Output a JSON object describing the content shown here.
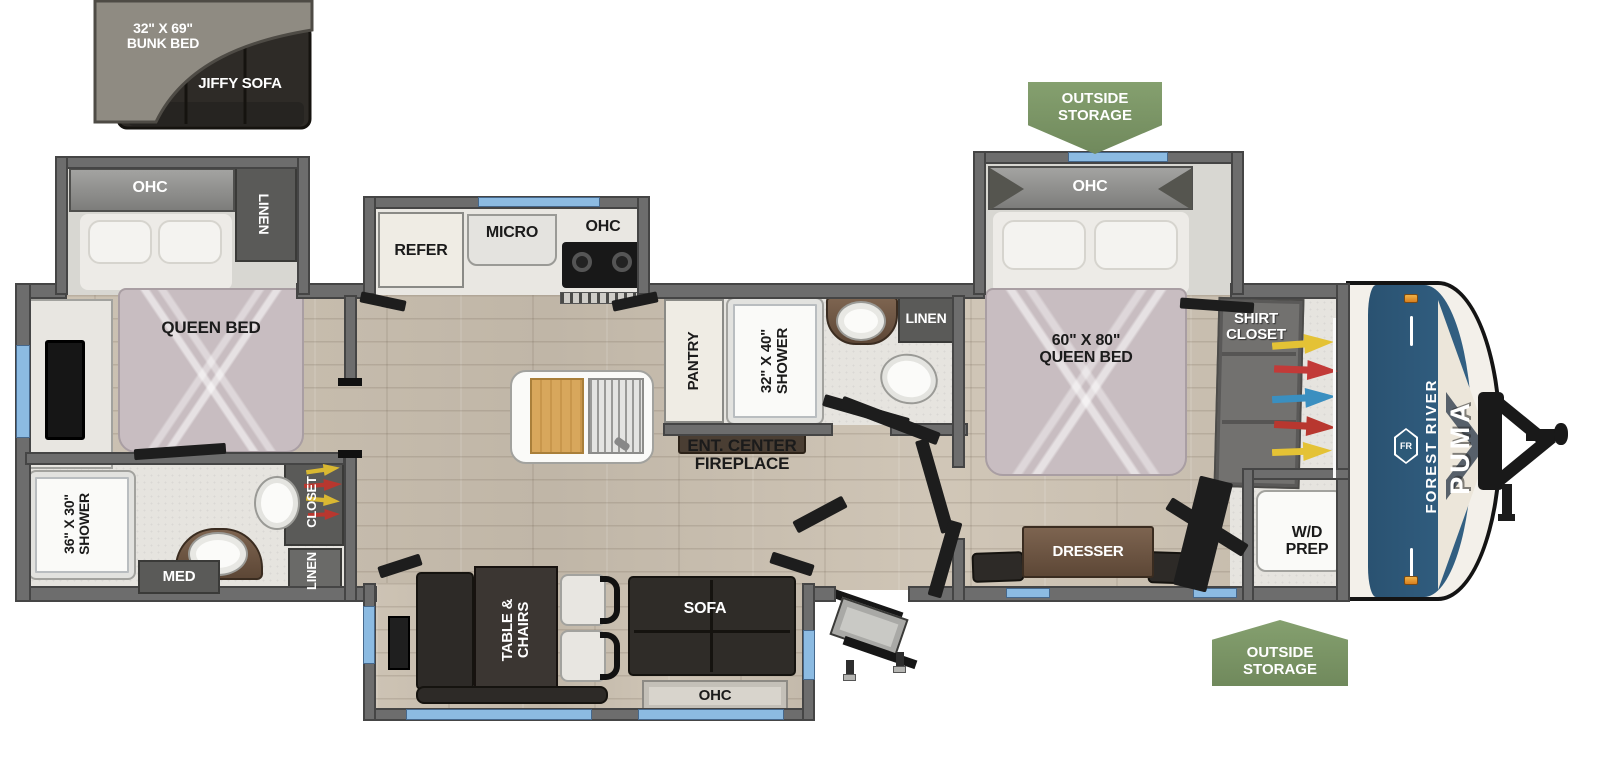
{
  "inset": {
    "bunk_label": "32\" X 69\"\nBUNK BED",
    "sofa_label": "JIFFY SOFA"
  },
  "storage": {
    "top": "OUTSIDE\nSTORAGE",
    "bottom": "OUTSIDE\nSTORAGE"
  },
  "rear_bedroom": {
    "ohc": "OHC",
    "linen": "LINEN",
    "bed": "QUEEN BED"
  },
  "rear_bath": {
    "shower": "36\" X 30\"\nSHOWER",
    "med": "MED",
    "closet": "CLOSET",
    "linen": "LINEN"
  },
  "kitchen": {
    "refer": "REFER",
    "micro": "MICRO",
    "ohc": "OHC",
    "pantry": "PANTRY"
  },
  "mid_bath": {
    "shower": "32\" X 40\"\nSHOWER",
    "linen": "LINEN"
  },
  "living": {
    "ent_center": "ENT. CENTER\nFIREPLACE",
    "table": "TABLE &\nCHAIRS",
    "sofa": "SOFA",
    "ohc": "OHC"
  },
  "front_bedroom": {
    "ohc": "OHC",
    "bed": "60\" X 80\"\nQUEEN BED",
    "shirt_closet": "SHIRT\nCLOSET",
    "dresser": "DRESSER",
    "wd_prep": "W/D\nPREP"
  },
  "brand": {
    "maker": "FOREST RIVER",
    "model": "PUMA",
    "logo": "FR"
  },
  "colors": {
    "banner_green": "#7d9468",
    "brand_blue": "#2d5a78",
    "window_blue": "#8cbbe2",
    "wall_gray": "#6d6d6d",
    "floor_wood": "#c9bfb0",
    "bed_pink": "#c8bdc1"
  }
}
